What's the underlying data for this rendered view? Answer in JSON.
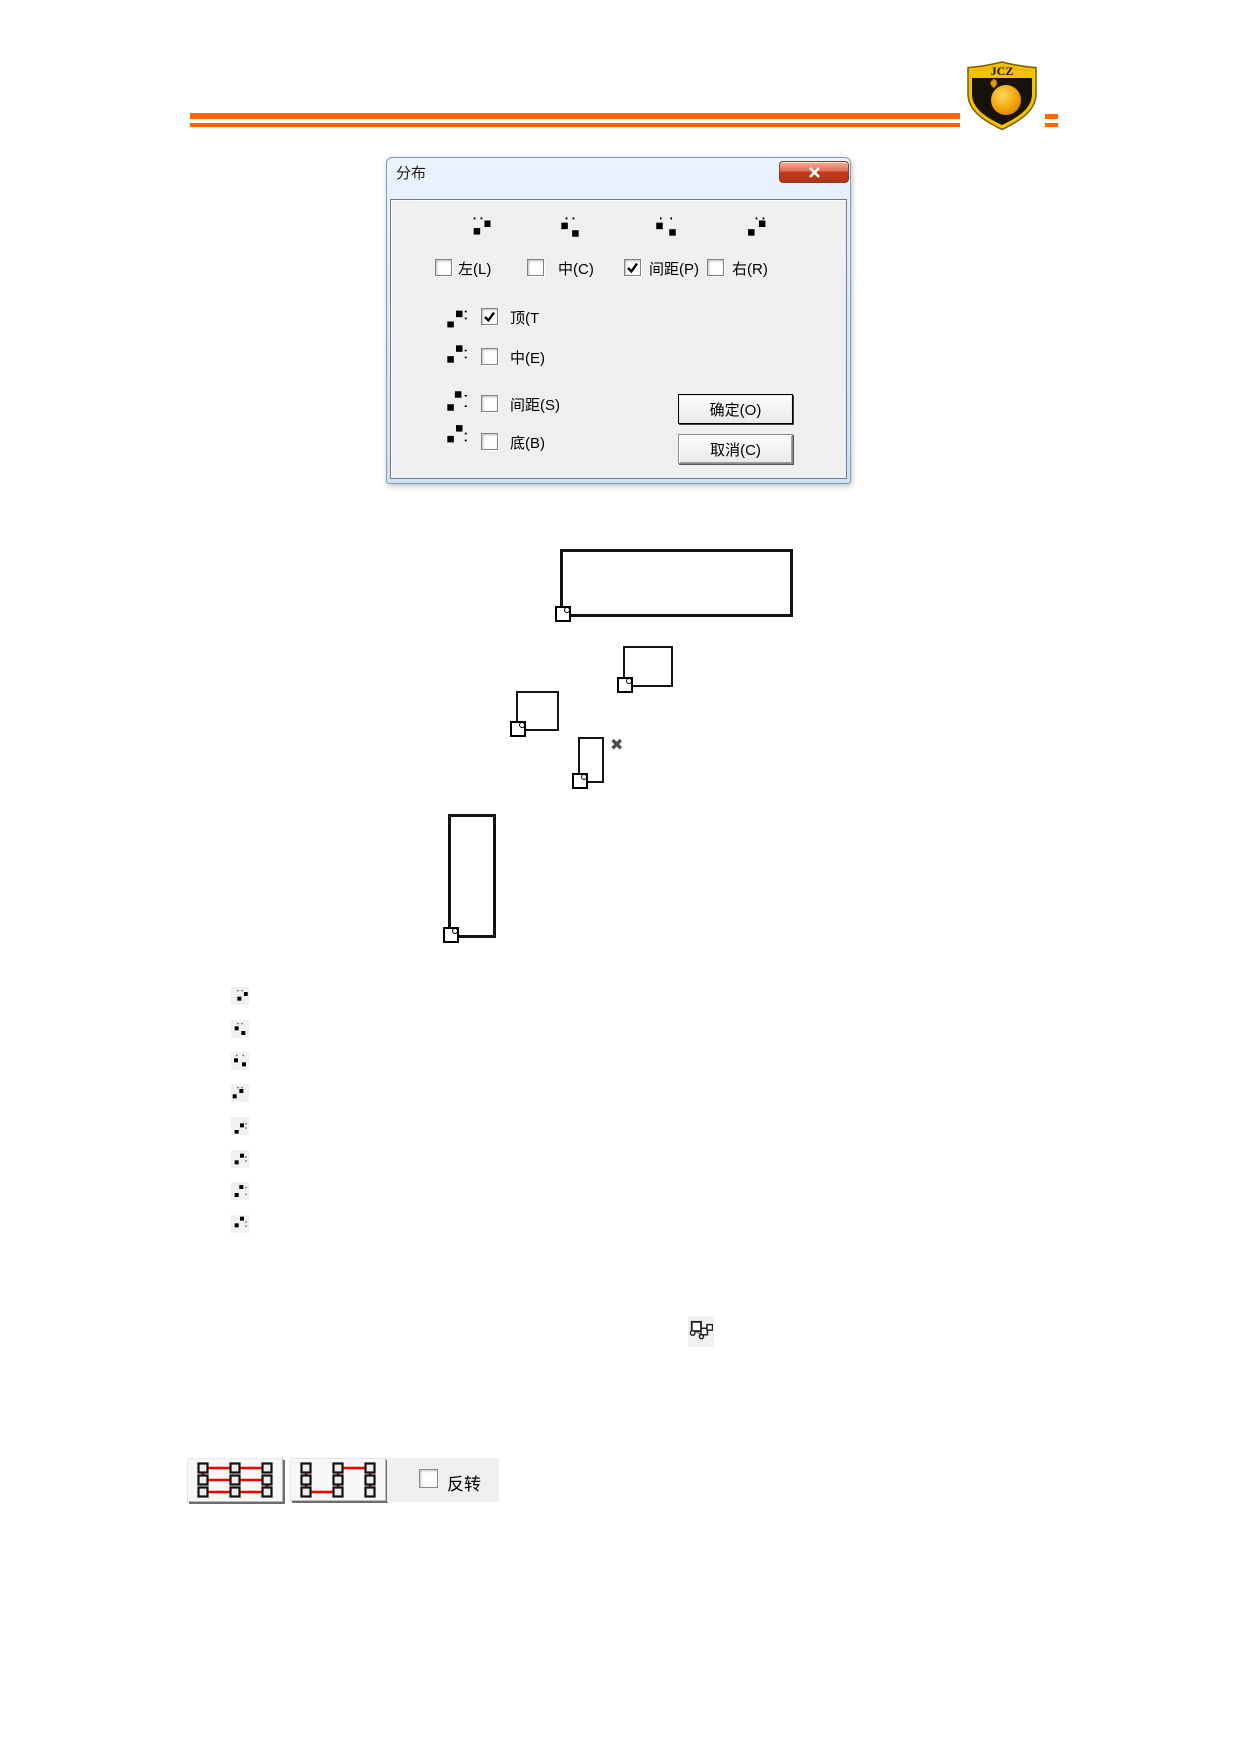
{
  "page": {
    "background": "#ffffff"
  },
  "header": {
    "rule_color": "#ff6600",
    "logo": {
      "text": "JCZ",
      "shield_color": "#f2c100",
      "field_color": "#17120b",
      "fruit_color": "#f49f00"
    }
  },
  "dialog": {
    "title": "分布",
    "close_icon": "close-x",
    "horizontal_group": {
      "icons": [
        "distribute-left-icon",
        "distribute-hcenter-icon",
        "distribute-hspacing-icon",
        "distribute-right-icon"
      ],
      "options": [
        {
          "label": "左(L)",
          "checked": false
        },
        {
          "label": "中(C)",
          "checked": false
        },
        {
          "label": "间距(P)",
          "checked": true
        },
        {
          "label": "右(R)",
          "checked": false
        }
      ]
    },
    "vertical_group": {
      "options": [
        {
          "label": "顶(T",
          "checked": true,
          "icon": "distribute-top-icon"
        },
        {
          "label": "中(E)",
          "checked": false,
          "icon": "distribute-vcenter-icon"
        },
        {
          "label": "间距(S)",
          "checked": false,
          "icon": "distribute-vspacing-icon"
        },
        {
          "label": "底(B)",
          "checked": false,
          "icon": "distribute-bottom-icon"
        }
      ]
    },
    "ok_button": "确定(O)",
    "cancel_button": "取消(C)"
  },
  "illustration": {
    "delete_mark": "✖",
    "handle_icon": "origin-handle"
  },
  "icon_list": [
    "distribute-left-icon",
    "distribute-hcenter-icon",
    "distribute-hspacing-icon",
    "distribute-right-icon",
    "distribute-top-icon",
    "distribute-vcenter-icon",
    "distribute-vspacing-icon",
    "distribute-bottom-icon"
  ],
  "group_icon": "object-nesting-icon",
  "toolbar": {
    "serpentine_color": "#f00000",
    "buttons": [
      "serpentine-horizontal-icon",
      "serpentine-vertical-icon"
    ],
    "invert": {
      "label": "反转",
      "checked": false
    }
  }
}
